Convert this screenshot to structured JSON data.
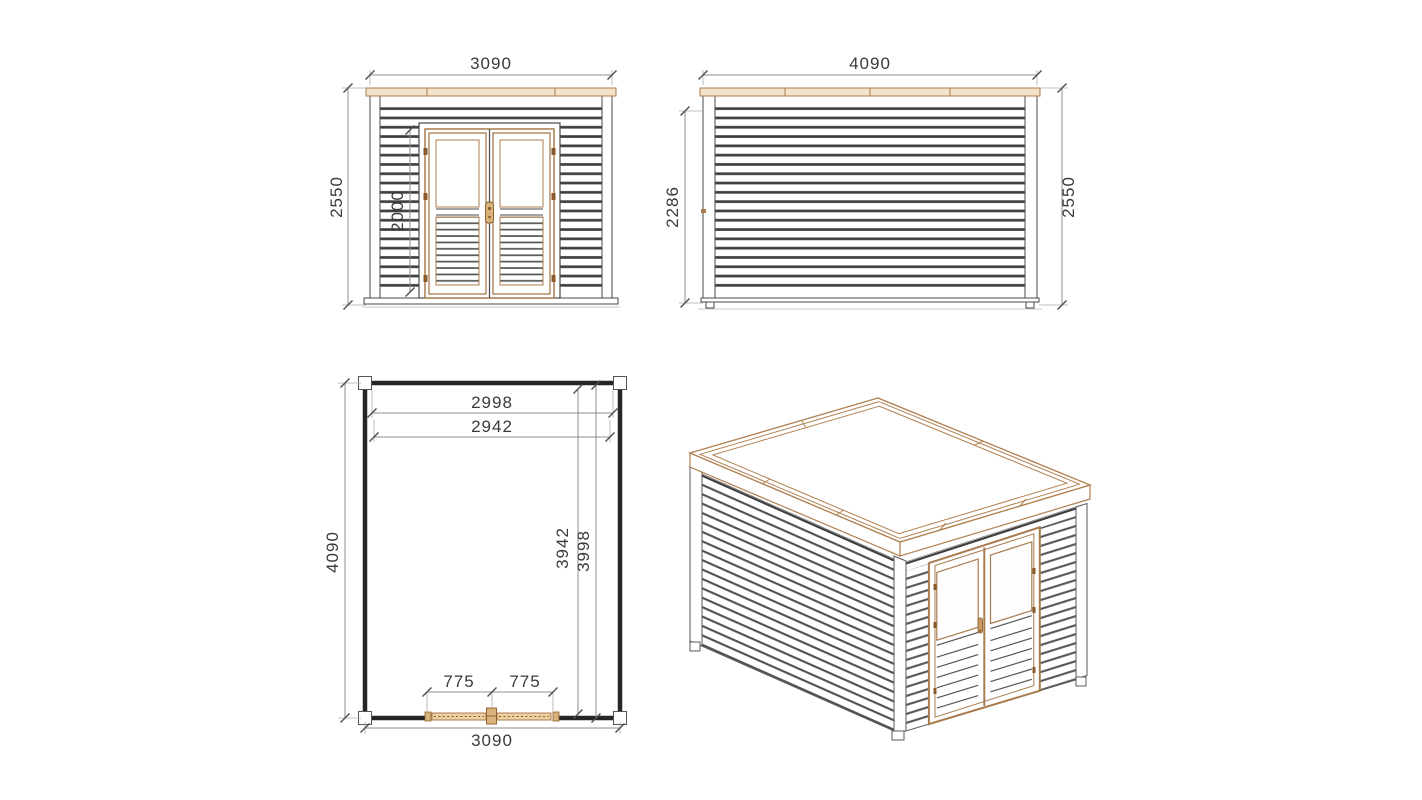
{
  "front_view": {
    "width": "3090",
    "height": "2550",
    "door_height": "2000"
  },
  "side_view": {
    "width": "4090",
    "wall_height": "2286",
    "height": "2550"
  },
  "plan_view": {
    "inner_width_top": "2998",
    "inner_width_second": "2942",
    "length": "4090",
    "inner_length_a": "3942",
    "inner_length_b": "3998",
    "door_leaf_left": "775",
    "door_leaf_right": "775",
    "width": "3090"
  },
  "colors": {
    "wood_accent": "#a97c4f",
    "wood_fill_light": "#f3e2c9",
    "wood_fill_mid": "#d9b37c",
    "slat_dark": "#3f3f3f",
    "dimension_line": "#8f8f8f",
    "dimension_text": "#3a3a3a",
    "background": "#ffffff"
  }
}
